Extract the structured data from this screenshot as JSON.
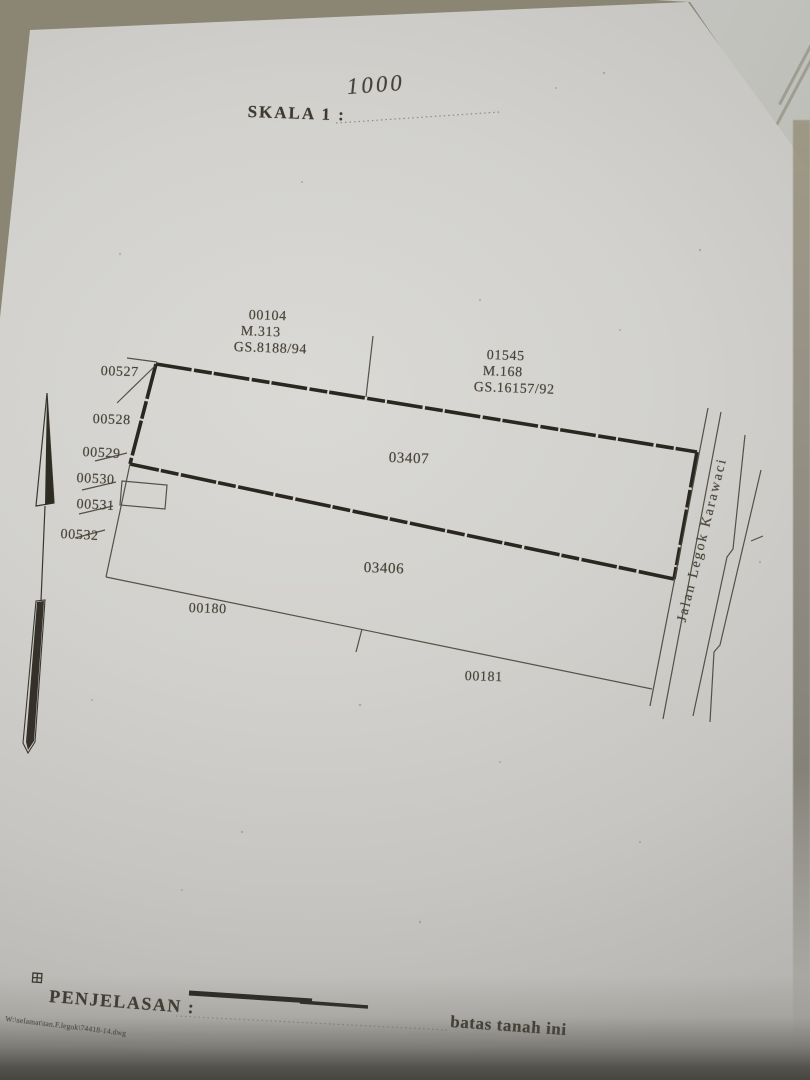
{
  "colors": {
    "ink": "#474338",
    "bold_line": "#2a2720",
    "paper": "#d2d1cd",
    "photo_background": "#8b8674"
  },
  "scale": {
    "label": "SKALA 1 :",
    "value": "1000"
  },
  "reference_marks": {
    "mark_a": {
      "point_id": "00104",
      "m_number": "M.313",
      "gs_number": "GS.8188/94"
    },
    "mark_b": {
      "point_id": "01545",
      "m_number": "M.168",
      "gs_number": "GS.16157/92"
    }
  },
  "left_boundary_points": [
    "00527",
    "00528",
    "00529",
    "00530",
    "00531",
    "00532"
  ],
  "parcels": {
    "upper_id": "03407",
    "lower_id": "03406"
  },
  "lower_boundary_points": {
    "left": "00180",
    "right": "00181"
  },
  "road": {
    "name": "Jalan Legok Karawaci"
  },
  "legend": {
    "title": "PENJELASAN :",
    "boundary_label": "batas tanah ini"
  },
  "footer": {
    "file_path": "W:\\selamat\\tan.F.legok\\74418-14.dwg"
  }
}
